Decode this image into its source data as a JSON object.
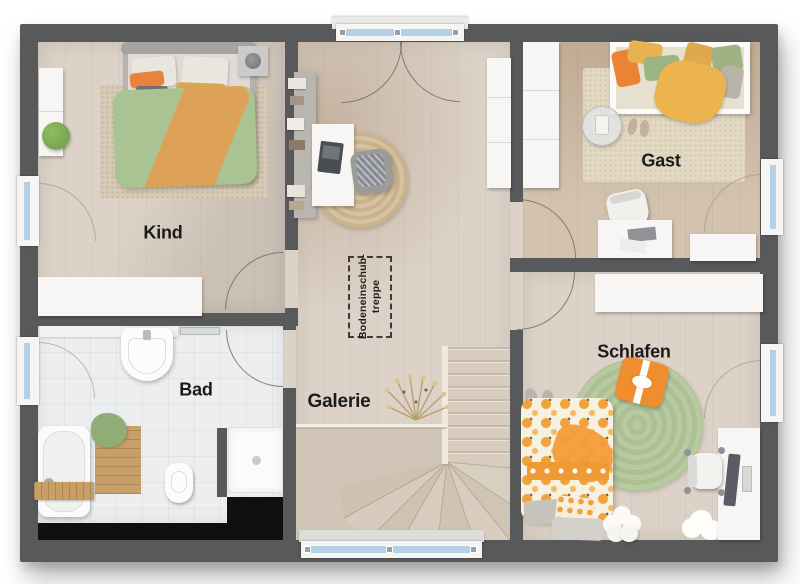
{
  "plan": {
    "rooms": [
      {
        "id": "kind",
        "label": "Kind"
      },
      {
        "id": "bad",
        "label": "Bad"
      },
      {
        "id": "galerie",
        "label": "Galerie"
      },
      {
        "id": "gast",
        "label": "Gast"
      },
      {
        "id": "schlafen",
        "label": "Schlafen"
      }
    ],
    "attic_hatch": {
      "line1": "Bodeneinschub-",
      "line2": "treppe"
    },
    "colors": {
      "wall": "#58595b",
      "wood_floor": "#dcd2c7",
      "gast_floor": "#d0bea8",
      "tile_floor": "#eceef0",
      "window_glass": "#b5d0e4",
      "void": "#101010",
      "accent_orange": "#ef9a33",
      "accent_green": "#a9c492",
      "rug_jute": "#d2bd97",
      "rug_green": "#b5c79b"
    }
  }
}
